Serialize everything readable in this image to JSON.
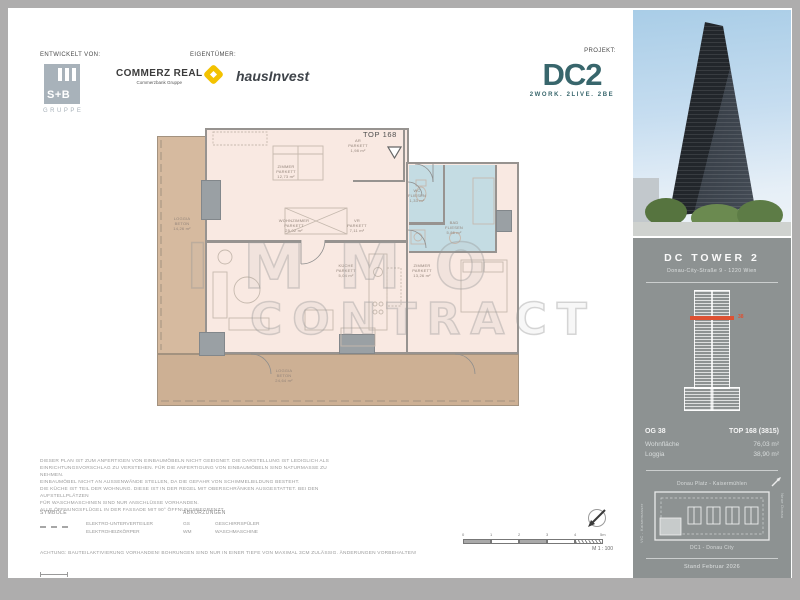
{
  "header": {
    "developed_by_label": "ENTWICKELT VON:",
    "owner_label": "EIGENTÜMER:",
    "project_label": "PROJEKT:",
    "sb_group": {
      "logo_text": "S+B",
      "subtitle": "GRUPPE"
    },
    "commerz_real": {
      "name": "COMMERZ REAL",
      "subtitle": "Commerzbank Gruppe"
    },
    "hausinvest_name": "hausInvest",
    "dc2": {
      "logo_text": "DC2",
      "tagline": "2WORK. 2LIVE. 2BE",
      "brand_color": "#38666c"
    }
  },
  "floorplan": {
    "unit_label": "TOP 168",
    "watermark": {
      "line1": "IMMO",
      "line2": "CONTRACT"
    },
    "rooms": {
      "zimmer1": {
        "name": "ZIMMER",
        "material": "PARKETT",
        "area": "12,73 m²"
      },
      "abstellraum": {
        "name": "AR",
        "material": "PARKETT",
        "area": "1,98 m²"
      },
      "vorraum": {
        "name": "VR",
        "material": "PARKETT",
        "area": "7,11 m²"
      },
      "wc": {
        "name": "WC",
        "material": "FLIESEN",
        "area": "1,33 m²"
      },
      "bad": {
        "name": "BAD",
        "material": "FLIESEN",
        "area": "5,86 m²"
      },
      "wohnzimmer": {
        "name": "WOHNZIMMER",
        "material": "PARKETT",
        "area": "25,02 m²"
      },
      "kueche": {
        "name": "KÜCHE",
        "material": "PARKETT",
        "area": "5,04 m²"
      },
      "zimmer2": {
        "name": "ZIMMER",
        "material": "PARKETT",
        "area": "13,26 m²"
      },
      "loggia_left": {
        "name": "LOGGIA",
        "material": "BETON",
        "area": "14,26 m²"
      },
      "loggia_bottom": {
        "name": "LOGGIA",
        "material": "BETON",
        "area": "24,64 m²"
      }
    }
  },
  "notes": {
    "lines": [
      "DIESER PLAN IST ZUM ANFERTIGEN VON EINBAUMÖBELN NICHT GEEIGNET. DIE DARSTELLUNG IST LEDIGLICH ALS",
      "EINRICHTUNGSVORSCHLAG ZU VERSTEHEN. FÜR DIE ANFERTIGUNG VON EINBAUMÖBELN SIND NATURMASSE ZU NEHMEN.",
      "EINBAUMÖBEL NICHT AN AUSSENWÄNDE STELLEN, DA DIE GEFAHR VON SCHIMMELBILDUNG BESTEHT.",
      "DIE KÜCHE IST TEIL DER WOHNUNG. DIESE IST IN DER REGEL MIT OBERSCHRÄNKEN AUSGESTATTET. BEI DEN AUFSTELLPLÄTZEN",
      "FÜR WASCHMASCHINEN SIND NUR ANSCHLÜSSE VORHANDEN.",
      "ALLE ÖFFNUNGSFLÜGEL IN DER FASSADE MIT 90° ÖFFNUNGSBEGRENZT."
    ]
  },
  "legend": {
    "symbols_header": "SYMBOLE",
    "symbols": [
      {
        "label": "ELEKTRO-UNTERVERTEILER"
      },
      {
        "label": "ELEKTROHEIZKÖRPER"
      }
    ],
    "abbreviations_header": "ABKÜRZUNGEN",
    "abbreviations": [
      {
        "abbr": "GS",
        "label": "GESCHIRRSPÜLER"
      },
      {
        "abbr": "WM",
        "label": "WASCHMASCHINE"
      }
    ],
    "warning": "ACHTUNG: BAUTEILAKTIVIERUNG VORHANDEN! BOHRUNGEN SIND NUR IN EINER TIEFE VON MAXIMAL 3CM ZULÄSSIG. ÄNDERUNGEN VORBEHALTEN!"
  },
  "scalebar": {
    "ticks": [
      "0",
      "1",
      "2",
      "3",
      "4",
      "5m"
    ],
    "scale_label": "M 1 : 100"
  },
  "sidebar": {
    "building_title": "DC TOWER 2",
    "address": "Donau-City-Straße 9 - 1220 Wien",
    "floor_marker": "38",
    "marker_color": "#dd5132",
    "unit_info": {
      "floor_label": "OG 38",
      "unit_number": "TOP 168 (3815)",
      "living_area_label": "Wohnfläche",
      "living_area_value": "76,03 m²",
      "loggia_label": "Loggia",
      "loggia_value": "38,90 m²"
    },
    "site_map": {
      "north_label": "Donau Platz - Kaisermühlen",
      "south_label": "DC1 - Donau City",
      "west_label": "VIC - Kaiserwasser",
      "east_label": "Neue Donau"
    },
    "date_note": "Stand Februar 2026"
  }
}
